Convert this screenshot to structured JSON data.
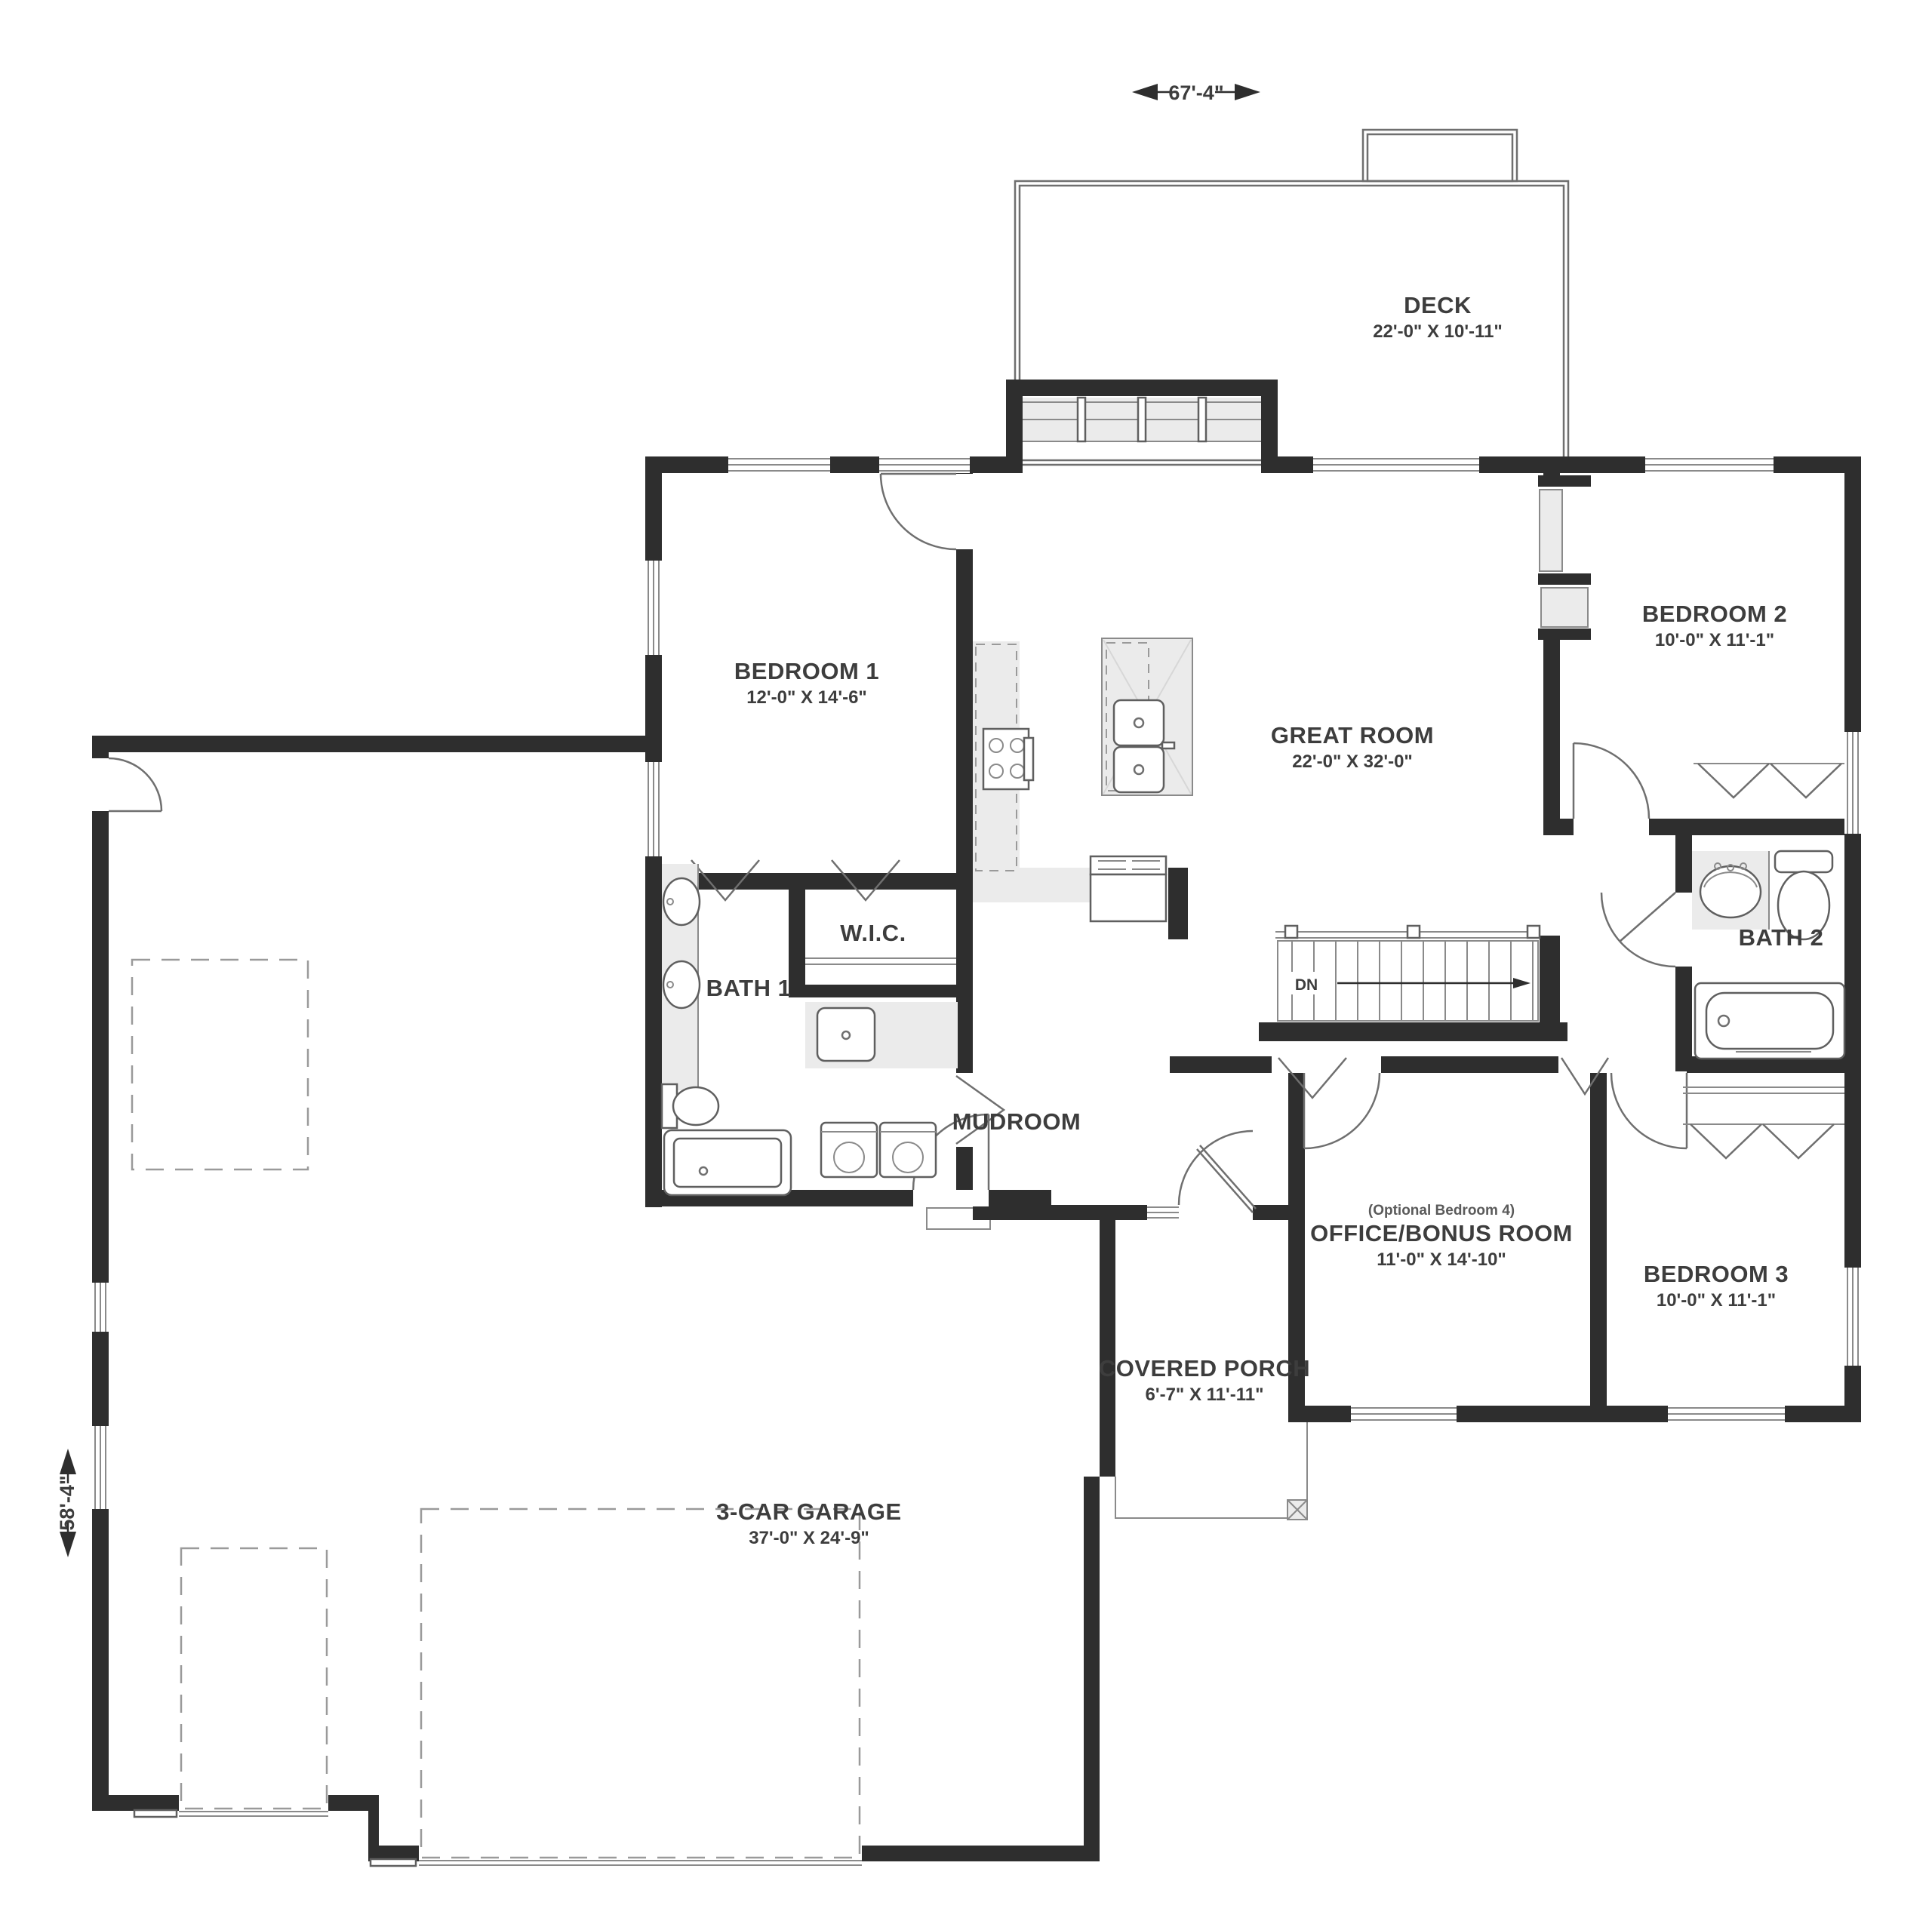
{
  "plan": {
    "title": "single-story house floor plan",
    "overall_width": "67'-4\"",
    "overall_depth": "58'-4\"",
    "stairs_label": "DN",
    "colors": {
      "wall": "#2e2e2e",
      "line": "#6f6f6f",
      "fill_light": "#ebebeb",
      "text": "#3d3d3d",
      "background": "#ffffff"
    },
    "rooms": [
      {
        "id": "deck",
        "name": "DECK",
        "dims": "22'-0\" X 10'-11\""
      },
      {
        "id": "bedroom-1",
        "name": "BEDROOM 1",
        "dims": "12'-0\" X 14'-6\""
      },
      {
        "id": "great-room",
        "name": "GREAT ROOM",
        "dims": "22'-0\" X 32'-0\""
      },
      {
        "id": "bedroom-2",
        "name": "BEDROOM 2",
        "dims": "10'-0\" X 11'-1\""
      },
      {
        "id": "wic",
        "name": "W.I.C.",
        "dims": ""
      },
      {
        "id": "bath-1",
        "name": "BATH 1",
        "dims": ""
      },
      {
        "id": "bath-2",
        "name": "BATH 2",
        "dims": ""
      },
      {
        "id": "mudroom",
        "name": "MUDROOM",
        "dims": ""
      },
      {
        "id": "office",
        "note": "(Optional Bedroom 4)",
        "name": "OFFICE/BONUS ROOM",
        "dims": "11'-0\" X 14'-10\""
      },
      {
        "id": "bedroom-3",
        "name": "BEDROOM 3",
        "dims": "10'-0\" X 11'-1\""
      },
      {
        "id": "porch",
        "name": "COVERED PORCH",
        "dims": "6'-7\" X 11'-11\""
      },
      {
        "id": "garage",
        "name": "3-CAR GARAGE",
        "dims": "37'-0\" X 24'-9\""
      }
    ]
  }
}
